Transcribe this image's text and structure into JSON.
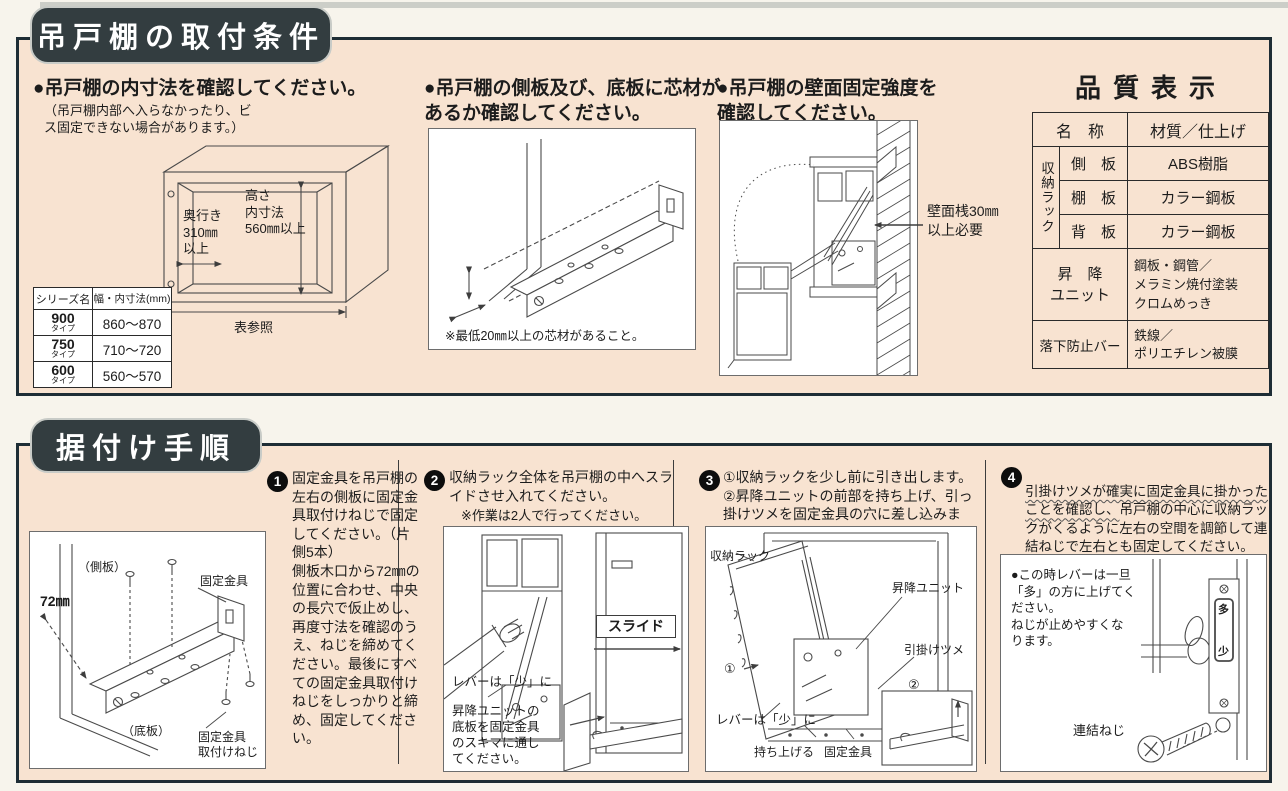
{
  "s1": {
    "title": "吊戸棚の取付条件",
    "i1": {
      "heading": "●吊戸棚の内寸法を確認してください。",
      "note": "（吊戸棚内部へ入らなかったり、ビ\nス固定できない場合があります。）",
      "depth_label": "奥行き\n310㎜\n以上",
      "height_label": "高さ\n内寸法\n560㎜以上",
      "ref_label": "表参照",
      "table": {
        "h1": "シリーズ名",
        "h2": "幅・内寸法(mm)",
        "r0s": "900",
        "r0t": "タイプ",
        "r0v": "860〜870",
        "r1s": "750",
        "r1t": "タイプ",
        "r1v": "710〜720",
        "r2s": "600",
        "r2t": "タイプ",
        "r2v": "560〜570"
      }
    },
    "i2": {
      "heading": "●吊戸棚の側板及び、底板に芯材が\nあるか確認してください。",
      "caption": "※最低20㎜以上の芯材があること。"
    },
    "i3": {
      "heading": "●吊戸棚の壁面固定強度を\n確認してください。",
      "wall_label": "壁面桟30㎜\n以上必要"
    },
    "q": {
      "title": "品質表示",
      "h_name": "名　称",
      "h_mat": "材質／仕上げ",
      "group": "収納ラック",
      "r0n": "側　板",
      "r0m": "ABS樹脂",
      "r1n": "棚　板",
      "r1m": "カラー鋼板",
      "r2n": "背　板",
      "r2m": "カラー鋼板",
      "lift_n": "昇　降\nユニット",
      "lift_m": "鋼板・鋼管／\nメラミン焼付塗装\nクロムめっき",
      "bar_n": "落下防止バー",
      "bar_m": "鉄線／\nポリエチレン被膜"
    }
  },
  "s2": {
    "title": "据付け手順",
    "st1": {
      "num": "1",
      "text": "固定金具を吊戸棚の左右の側板に固定金具取付けねじで固定してください。（片側5本）\n側板木口から72㎜の位置に合わせ、中央の長穴で仮止めし、再度寸法を確認のうえ、ねじを締めてください。最後にすべての固定金具取付けねじをしっかりと締め、固定してください。",
      "lb_side": "（側板）",
      "lb_dim": "72㎜",
      "lb_bracket": "固定金具",
      "lb_bottom": "（底板）",
      "lb_screw": "固定金具\n取付けねじ"
    },
    "st2": {
      "num": "2",
      "text": "収納ラック全体を吊戸棚の中へスライドさせ入れてください。",
      "note": "※作業は2人で行ってください。",
      "lb_slide": "スライド",
      "lb_lever": "レバーは「少」に",
      "lb_hint": "昇降ユニットの\n底板を固定金具\nのスキマに通し\nてください。"
    },
    "st3": {
      "num": "3",
      "text": "①収納ラックを少し前に引き出します。\n②昇降ユニットの前部を持ち上げ、引っ掛けツメを固定金具の穴に差し込みます。",
      "lb_rack": "収納ラック",
      "lb_unit": "昇降ユニット",
      "lb_hook": "引掛けツメ",
      "lb_m1": "①",
      "lb_m2": "②",
      "lb_lever": "レバーは「少」に",
      "lb_up": "持ち上げる",
      "lb_bracket": "固定金具"
    },
    "st4": {
      "num": "4",
      "text_em": "引掛けツメが確実に固定金具に掛かったことを確認し、",
      "text_rest": "吊戸棚の中心に収納ラックがくるように左右の空間を調節して連結ねじで左右とも固定してください。",
      "note": "●この時レバーは一旦\n「多」の方に上げてく\nださい。\nねじが止めやすくな\nります。",
      "lb_screw": "連結ねじ",
      "lb_more": "多",
      "lb_less": "少"
    }
  }
}
